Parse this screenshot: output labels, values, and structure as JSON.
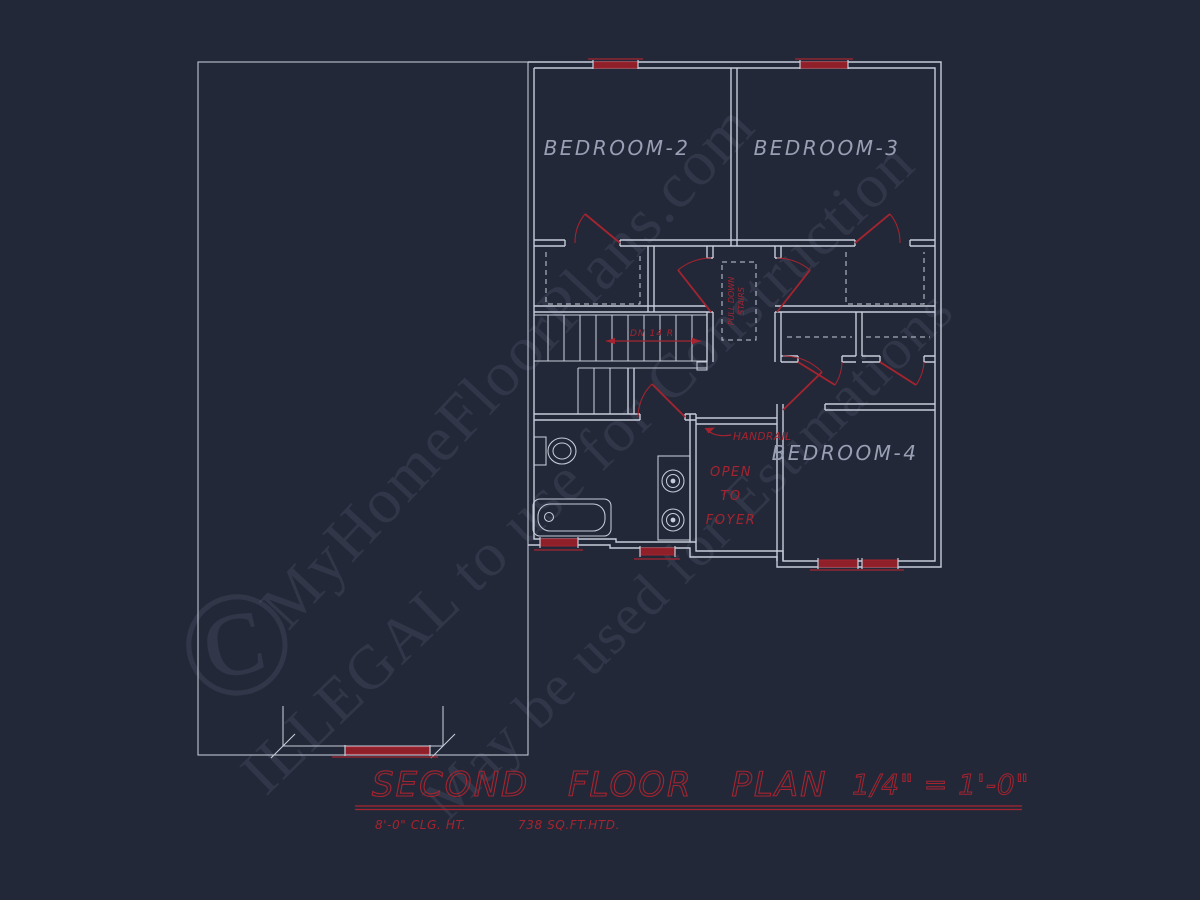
{
  "colors": {
    "background": "#232838",
    "wall_line": "#c6ccd9",
    "room_label": "#99a0b4",
    "annotation_red": "#a5242f",
    "window_fill_red": "#8f1f29",
    "watermark": "#aeb6d0"
  },
  "plan": {
    "rooms": [
      {
        "label": "BEDROOM-2"
      },
      {
        "label": "BEDROOM-3"
      },
      {
        "label": "BEDROOM-4"
      }
    ],
    "annotations": {
      "stairs_dn": "DN 14 R",
      "pull_down_line1": "PULL DOWN",
      "pull_down_line2": "STAIRS",
      "handrail": "HANDRAIL",
      "open_line1": "OPEN",
      "open_line2": "TO",
      "open_line3": "FOYER"
    }
  },
  "title_block": {
    "title": "SECOND FLOOR PLAN",
    "scale": "1/4\" = 1'-0\"",
    "ceiling_height": "8'-0\" CLG. HT.",
    "heated_area": "738 SQ.FT.HTD."
  },
  "watermark": {
    "copyright_symbol": "©",
    "site": "MyHomeFloorPlans.com",
    "notice1": "ILLEGAL to use for Construction",
    "notice2": "May be used for Estimations"
  }
}
